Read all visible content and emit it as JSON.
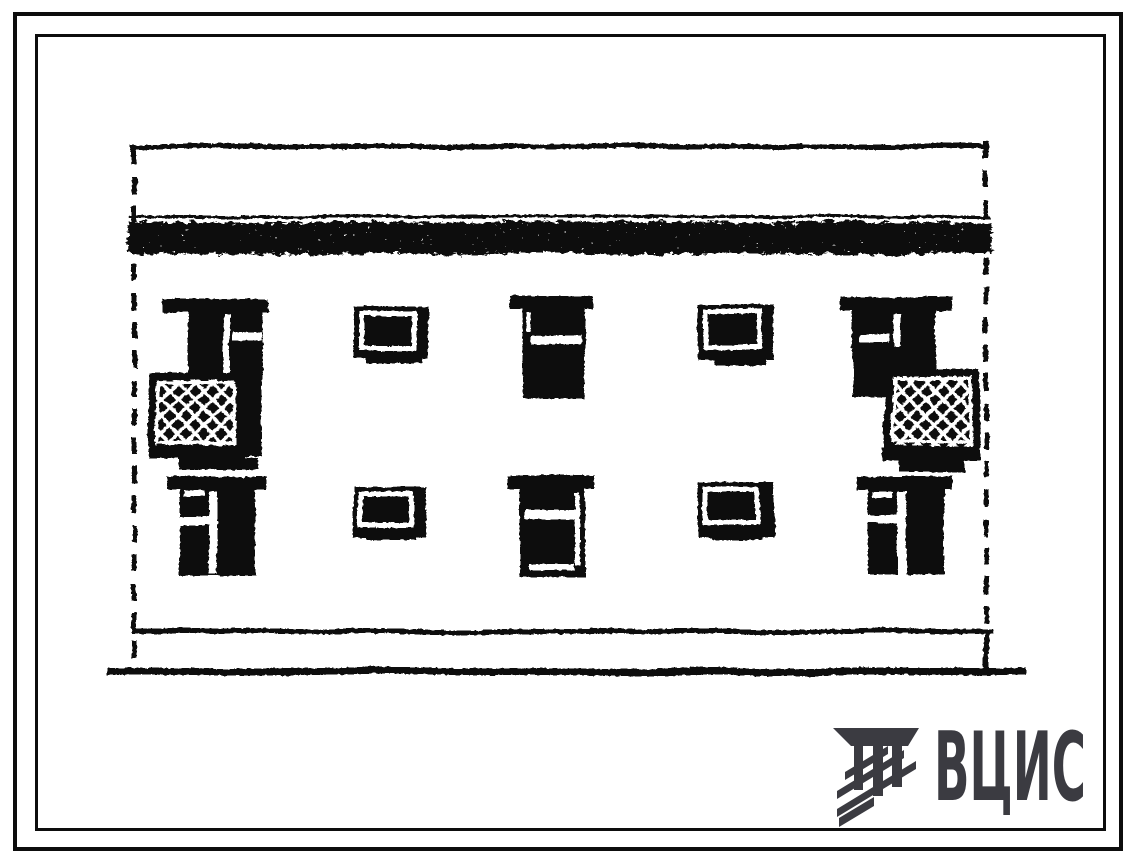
{
  "page": {
    "background": "#ffffff",
    "ink": "#0d0d0d"
  },
  "drawing": {
    "subject": "two-storey building facade elevation",
    "style": "scanned black-ink standard-design (tipovoy proyekt) drawing",
    "storeys": 2,
    "upper_row": [
      "window with balcony door and balcony (left)",
      "small window",
      "window",
      "small window",
      "window with balcony door and balcony (right)"
    ],
    "lower_row": [
      "double window",
      "small window",
      "window",
      "small window",
      "double window"
    ],
    "features": [
      "dashed section boundary lines left and right",
      "textured parapet band under roof line",
      "plinth line and ground line at bottom"
    ]
  },
  "logo": {
    "text": "ВЦИС",
    "icon": "vcis-emblem-columns-hatched",
    "color": "#3b3b41"
  }
}
